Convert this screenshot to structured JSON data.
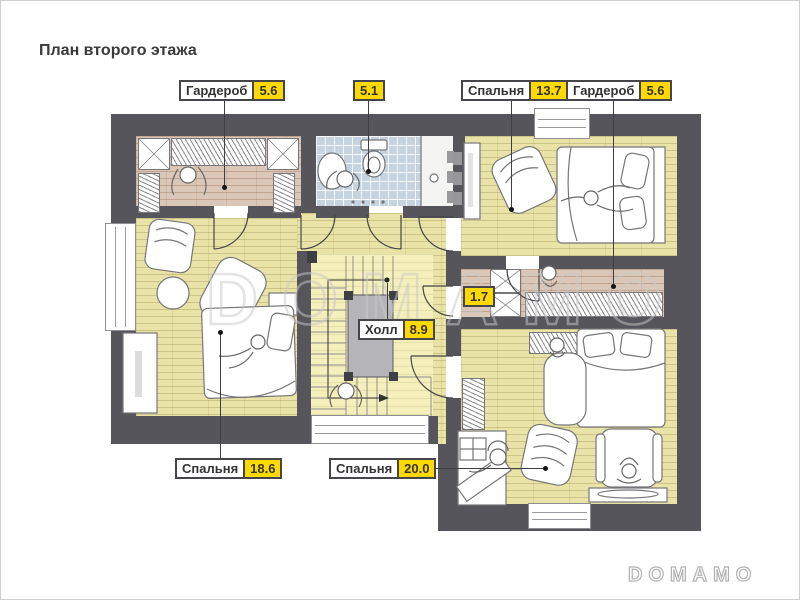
{
  "title": "План второго этажа",
  "watermark": "DOMAMO",
  "brand_logo": "DOMAMO",
  "labels": {
    "wardrobe_left": {
      "name": "Гардероб",
      "area": "5.6"
    },
    "bathroom": {
      "area": "5.1"
    },
    "bedroom_top": {
      "name": "Спальня",
      "area": "13.7"
    },
    "wardrobe_right": {
      "name": "Гардероб",
      "area": "5.6"
    },
    "closet": {
      "area": "1.7"
    },
    "hall": {
      "name": "Холл",
      "area": "8.9"
    },
    "bedroom_left": {
      "name": "Спальня",
      "area": "18.6"
    },
    "bedroom_bottom": {
      "name": "Спальня",
      "area": "20.0"
    }
  },
  "colors": {
    "accent_yellow": "#ffd900",
    "wall": "#55555b",
    "floor_wood": "#e9e3a7",
    "floor_wood_pale": "#f5efbb",
    "floor_wood_pink": "#dac7b7",
    "floor_tile": "#c6d4e2",
    "outline": "#46464a"
  }
}
